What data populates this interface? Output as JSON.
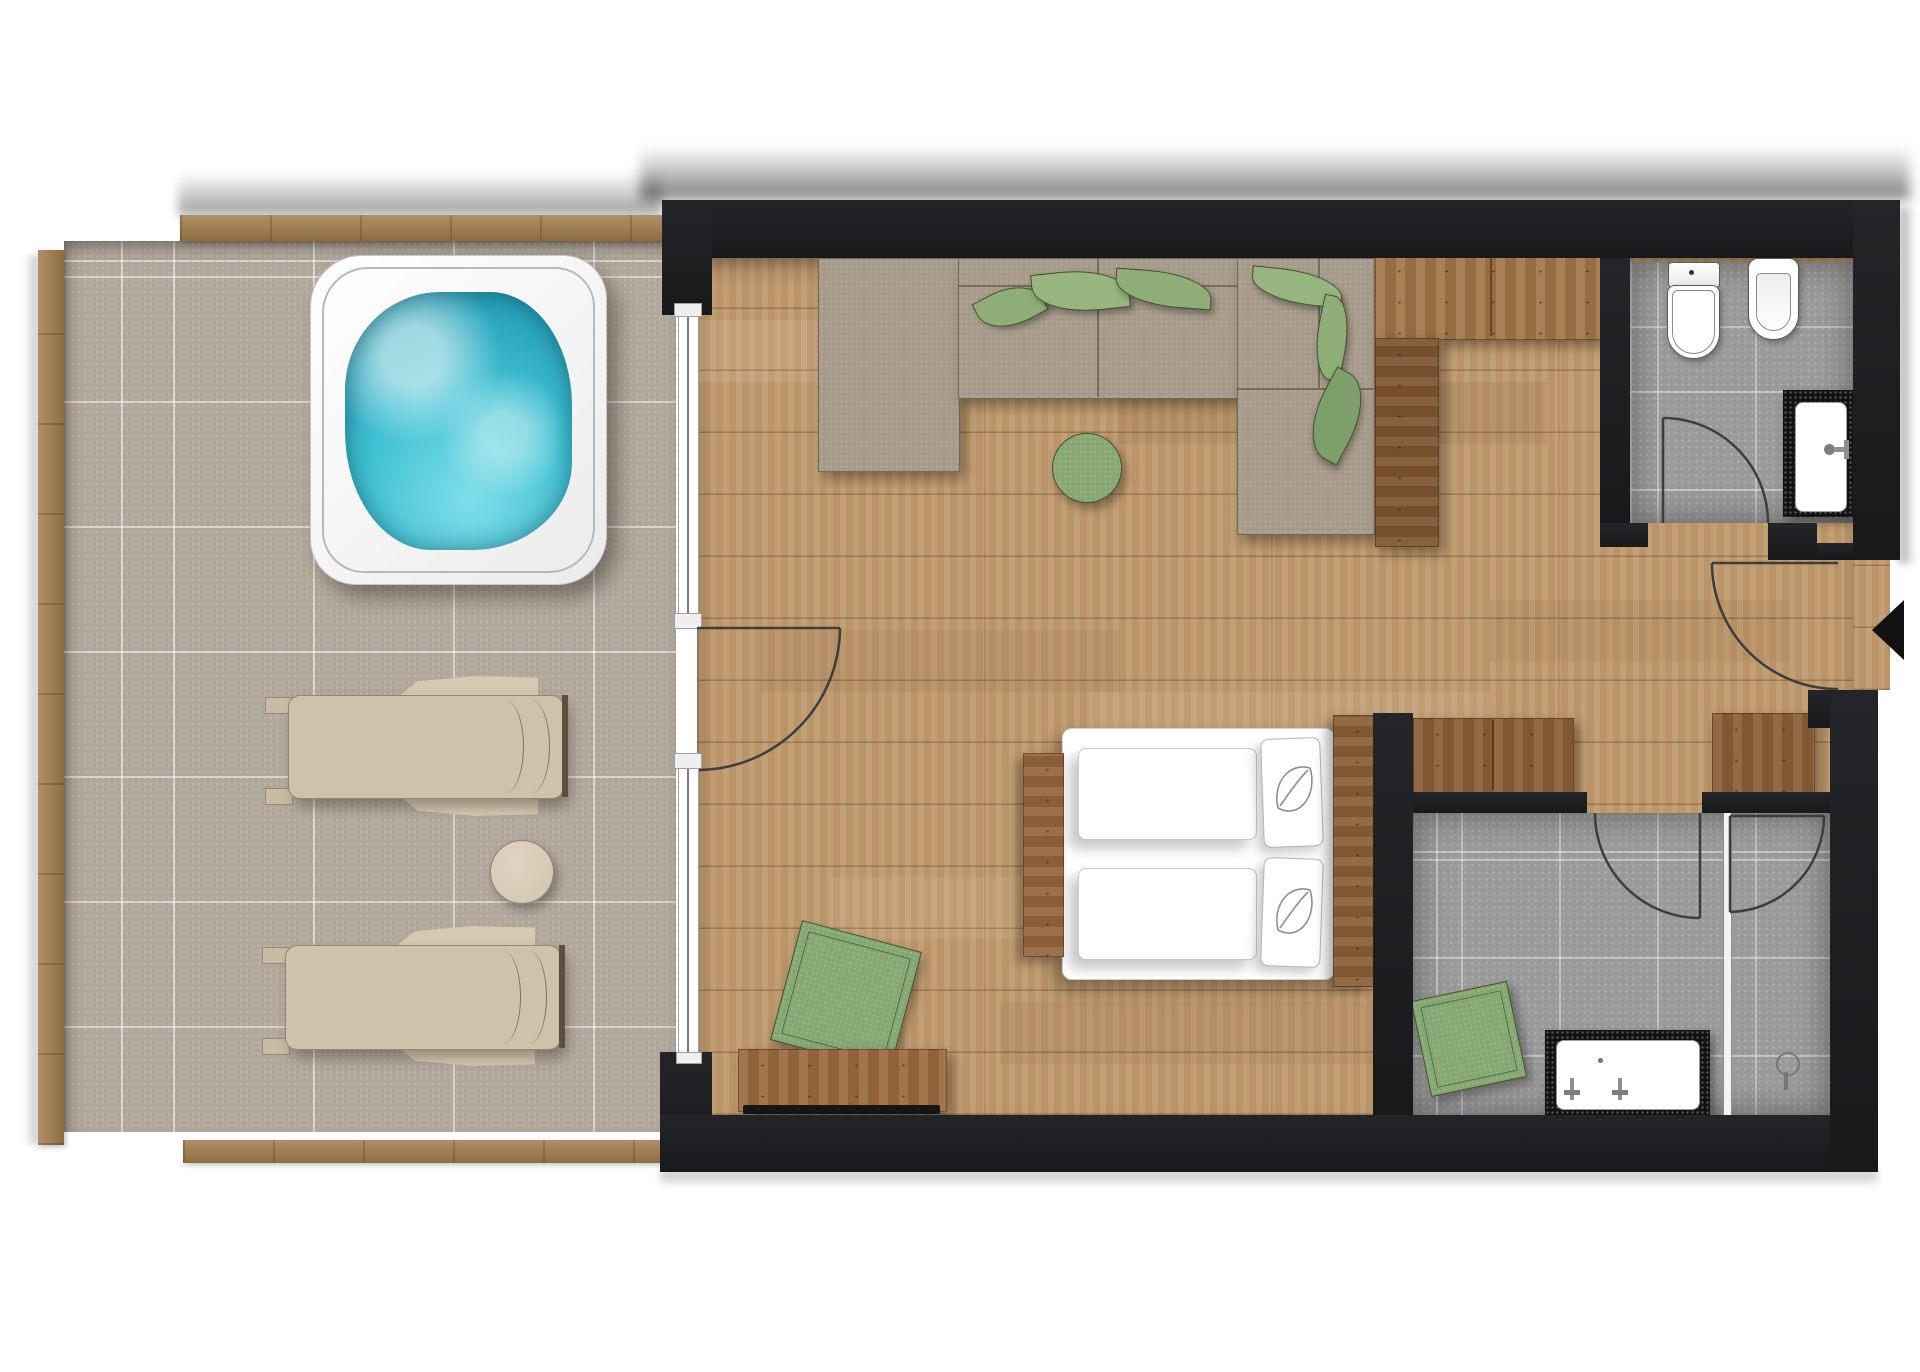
{
  "page": {
    "title": "Suite floor plan (top view)",
    "background": "#ffffff"
  },
  "palette": {
    "wall": "#1b1c1e",
    "oak_floor": "#c09a6e",
    "rustic_wood": "#8a5f38",
    "deck_wood": "#a37c4c",
    "terrace_stone": "#b2a79b",
    "grey_tile": "#9a9a9a",
    "sofa_taupe": "#a69b8a",
    "accent_green": "#85a873",
    "leaf_green": "#8fae77",
    "water_turquoise": "#3fc0d3",
    "lounger_beige": "#cfc2ab",
    "porcelain": "#ffffff",
    "counter_black": "#131313",
    "door_arc": "#3d3d3d"
  },
  "plan": {
    "rooms": [
      {
        "id": "terrace",
        "label": "Terrace",
        "floor": "stone tiles with wood edging",
        "features": [
          "hot tub",
          "sun lounger",
          "sun lounger",
          "round side table"
        ]
      },
      {
        "id": "living",
        "label": "Living area",
        "floor": "oak planks",
        "features": [
          "modular sofa",
          "leaf cushions",
          "round pouf",
          "wardrobe"
        ]
      },
      {
        "id": "bedroom",
        "label": "Bedroom",
        "floor": "oak planks",
        "features": [
          "double bed",
          "two mattresses",
          "two pillows",
          "headboard",
          "foot bench",
          "sideboard",
          "green rug",
          "wall cabinet",
          "wall cabinet"
        ]
      },
      {
        "id": "wc",
        "label": "WC",
        "floor": "grey stone tiles",
        "features": [
          "toilet",
          "bidet",
          "washbasin"
        ]
      },
      {
        "id": "bathroom",
        "label": "Bathroom",
        "floor": "grey stone tiles",
        "features": [
          "double vanity",
          "walk-in shower",
          "glass partition",
          "green stool",
          "towel radiator"
        ]
      },
      {
        "id": "hallway",
        "label": "Entrance hall",
        "floor": "oak planks",
        "features": [
          "entrance door",
          "entrance arrow marker"
        ]
      }
    ],
    "windows": [
      {
        "id": "window-upper",
        "label": "Terrace window upper"
      },
      {
        "id": "window-lower",
        "label": "Terrace window lower"
      }
    ],
    "doors": [
      {
        "id": "terrace-door",
        "label": "Terrace door"
      },
      {
        "id": "entry-door",
        "label": "Entrance door"
      },
      {
        "id": "wc-door",
        "label": "WC door"
      },
      {
        "id": "bathroom-door",
        "label": "Bathroom door"
      },
      {
        "id": "shower-door",
        "label": "Shower door"
      }
    ],
    "entrance_marker": {
      "shape": "triangle",
      "direction": "left"
    }
  }
}
